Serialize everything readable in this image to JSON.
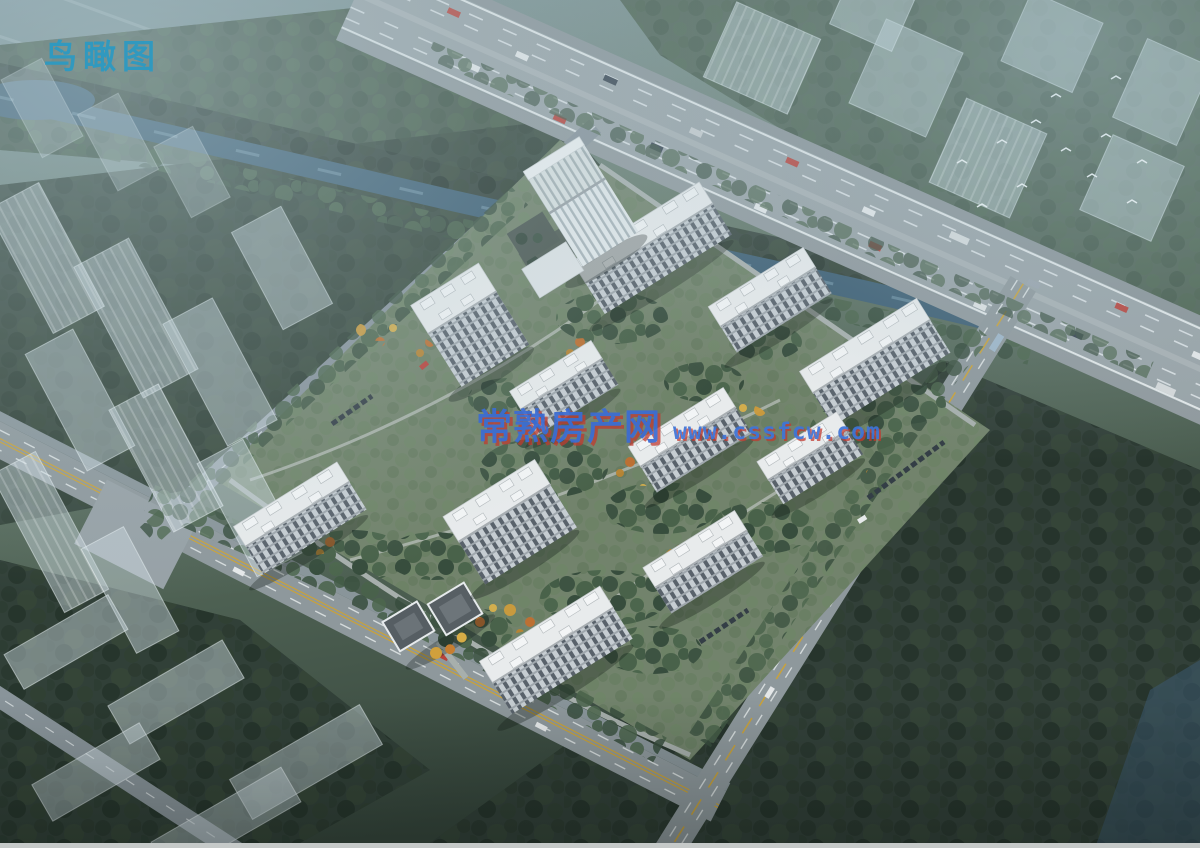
{
  "scene": {
    "view_label": "鸟瞰图",
    "watermark": {
      "site_name": "常熟房产网",
      "url": "www.cssfcw.com"
    },
    "palette": {
      "label_teal": "#2D9AC2",
      "watermark_blue": "#3B6CD4",
      "watermark_red_shadow": "#C0392F",
      "water": "#3E5F74",
      "road_gray": "#99A3A7",
      "forest_dark": "#2C3D31",
      "site_lawn": "#72836C",
      "tower_roof_white": "#E8EBEC",
      "tower_facade_light": "#C6CDD2",
      "tower_facade_dark": "#59626B",
      "autumn_yellow": "#CD9B3C",
      "autumn_orange": "#C06F30",
      "haze_blue": "#A9C2CC"
    }
  }
}
